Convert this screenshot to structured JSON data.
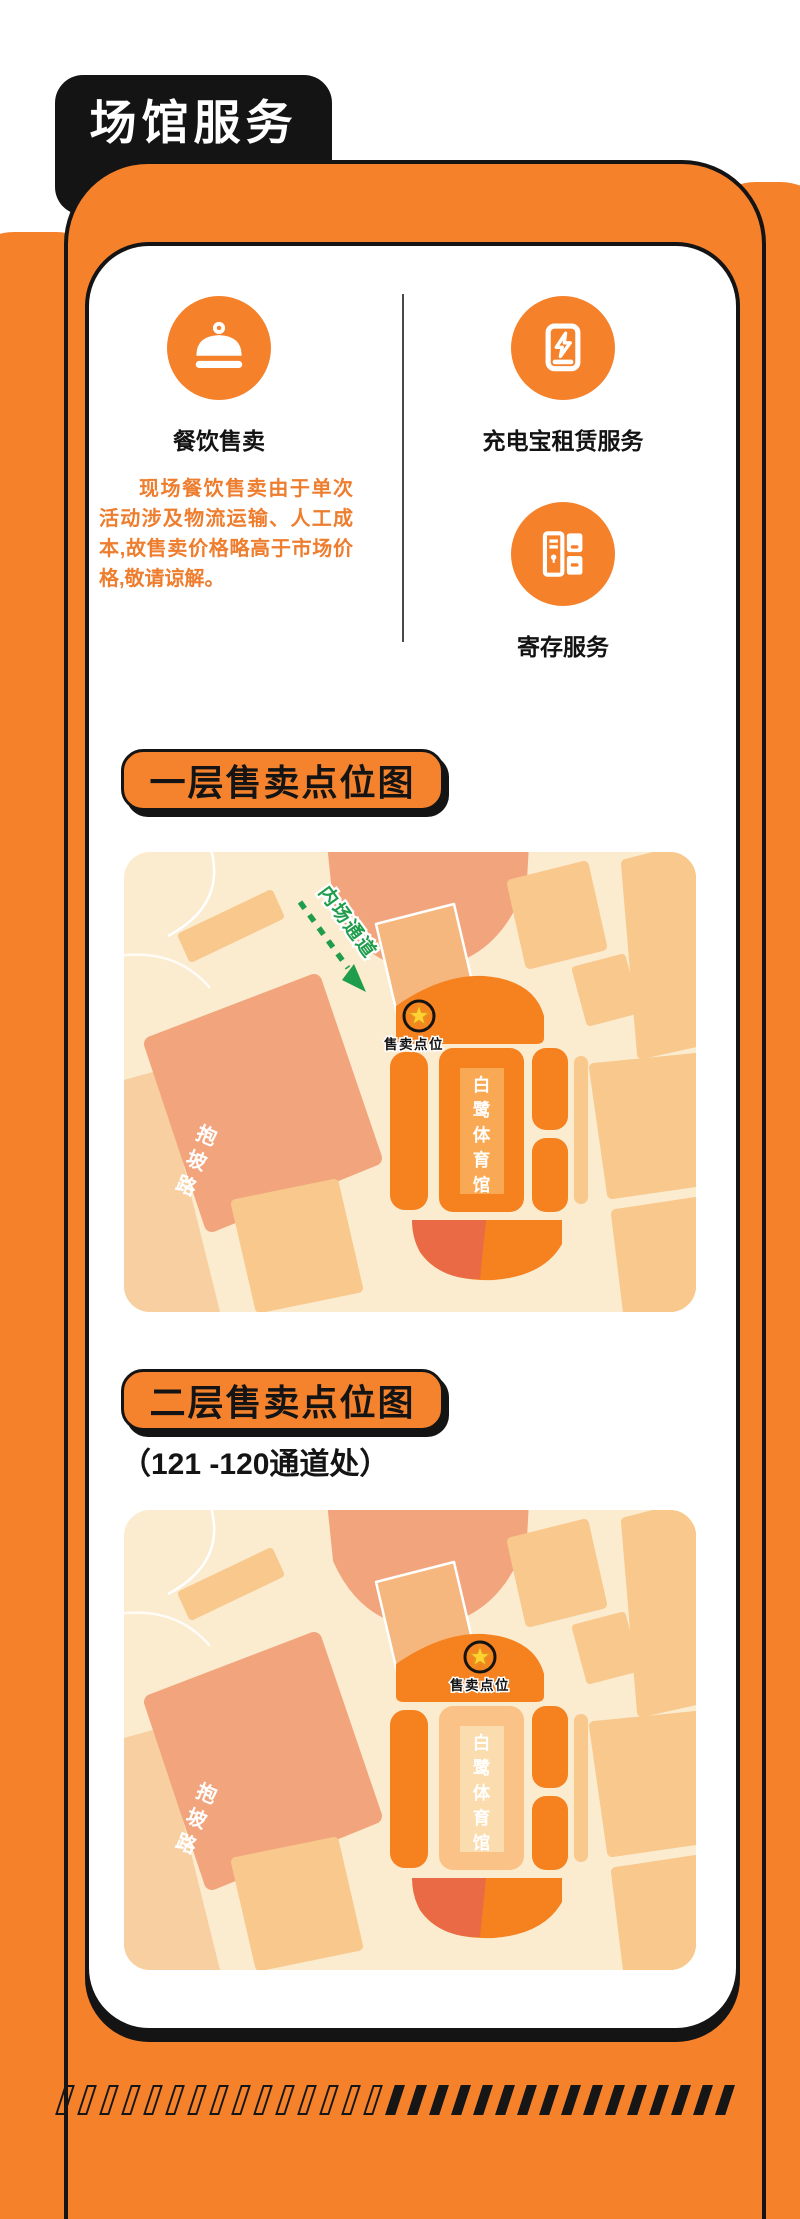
{
  "header": {
    "title": "场馆服务"
  },
  "card": {
    "services": {
      "food": {
        "icon": "cloche-icon",
        "label": "餐饮售卖",
        "note": "现场餐饮售卖由于单次活动涉及物流运输、人工成本,故售卖价格略高于市场价格,敬请谅解。"
      },
      "powerbank": {
        "icon": "power-bank-icon",
        "label": "充电宝租赁服务"
      },
      "storage": {
        "icon": "locker-icon",
        "label": "寄存服务"
      }
    },
    "sections": [
      {
        "title": "一层售卖点位图",
        "subtitle": "",
        "map": {
          "stadium_name": "白鹭体育馆",
          "road_name": "抱坡路",
          "marker_label": "售卖点位",
          "route_label": "内场通道"
        }
      },
      {
        "title": "二层售卖点位图",
        "subtitle": "（121 -120通道处）",
        "map": {
          "stadium_name": "白鹭体育馆",
          "road_name": "抱坡路",
          "marker_label": "售卖点位"
        }
      }
    ]
  },
  "footer": {
    "dash_outline_count": 15,
    "dash_solid_count": 16
  },
  "colors": {
    "brand_orange": "#F5812B",
    "ink_black": "#141414",
    "route_green": "#1F9D4B",
    "star_yellow": "#FFD233",
    "note_orange": "#EE7D2E",
    "map_cream": "#FBEBCF"
  }
}
